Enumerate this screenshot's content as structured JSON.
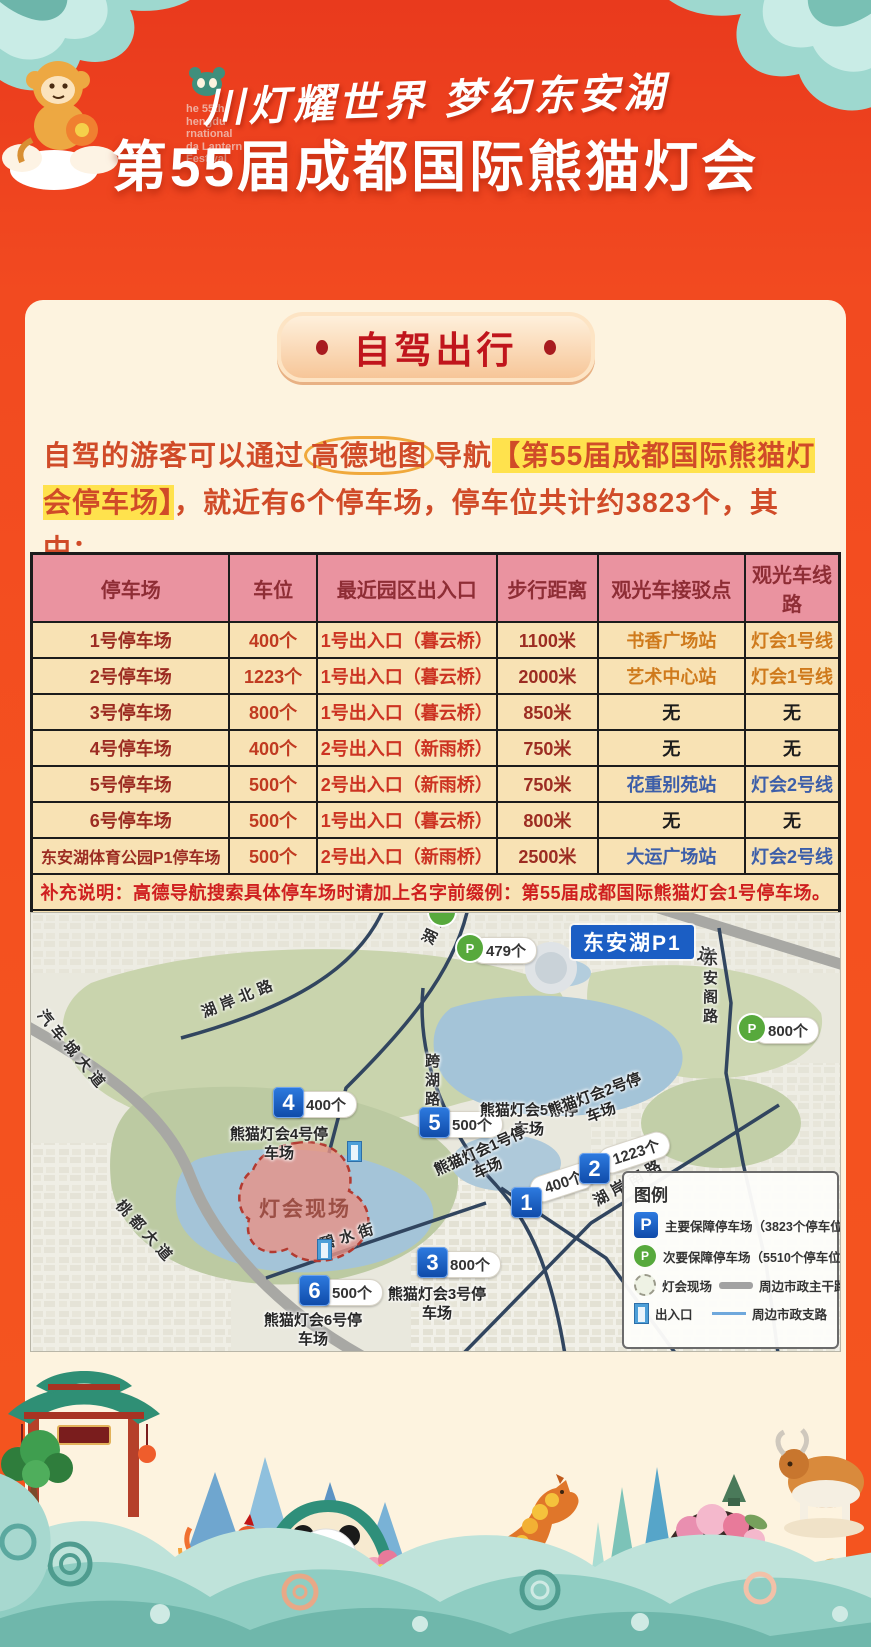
{
  "colors": {
    "accent_red": "#e8401f",
    "card_bg": "#fdf3df",
    "table_header_bg": "#ea93a0",
    "highlight_yellow": "#ffe24d",
    "marker_blue": "#1b5ec4",
    "marker_green": "#57a93c"
  },
  "header": {
    "festival_logo_text": "he 55th\nhengdu\nrnational\nda Lantern\nFestival",
    "subtitle": "川灯耀世界 梦幻东安湖",
    "title": "第55届成都国际熊猫灯会"
  },
  "section": {
    "badge": "自驾出行",
    "intro_pre": "自驾的游客可以通过",
    "intro_circled": "高德地图",
    "intro_mid": "导航",
    "intro_highlight": "【第55届成都国际熊猫灯会停车场】",
    "intro_post": "，就近有6个停车场，停车位共计约3823个，其中："
  },
  "table": {
    "headers": [
      "停车场",
      "车位",
      "最近园区出入口",
      "步行距离",
      "观光车接驳点",
      "观光车线路"
    ],
    "rows": [
      {
        "name": "1号停车场",
        "spots": "400个",
        "exit": "1号出入口（暮云桥）",
        "dist": "1100米",
        "station": "书香广场站",
        "line": "灯会1号线",
        "cls": "c-orange"
      },
      {
        "name": "2号停车场",
        "spots": "1223个",
        "exit": "1号出入口（暮云桥）",
        "dist": "2000米",
        "station": "艺术中心站",
        "line": "灯会1号线",
        "cls": "c-orange"
      },
      {
        "name": "3号停车场",
        "spots": "800个",
        "exit": "1号出入口（暮云桥）",
        "dist": "850米",
        "station": "无",
        "line": "无",
        "cls": "c-dark"
      },
      {
        "name": "4号停车场",
        "spots": "400个",
        "exit": "2号出入口（新雨桥）",
        "dist": "750米",
        "station": "无",
        "line": "无",
        "cls": "c-dark"
      },
      {
        "name": "5号停车场",
        "spots": "500个",
        "exit": "2号出入口（新雨桥）",
        "dist": "750米",
        "station": "花重别苑站",
        "line": "灯会2号线",
        "cls": "c-blue"
      },
      {
        "name": "6号停车场",
        "spots": "500个",
        "exit": "1号出入口（暮云桥）",
        "dist": "800米",
        "station": "无",
        "line": "无",
        "cls": "c-dark"
      },
      {
        "name": "东安湖体育公园P1停车场",
        "spots": "500个",
        "exit": "2号出入口（新雨桥）",
        "dist": "2500米",
        "station": "大运广场站",
        "line": "灯会2号线",
        "cls": "c-blue"
      }
    ],
    "note1": "补充说明：高德导航搜索具体停车场时请加上名字前缀例：第55届成都国际熊猫灯会1号停车场。",
    "note2": "温馨提示：所有的停车场、观光车接驳点、园区出入口都能使用高德地图导航和搜索，祝您游览愉快!"
  },
  "map": {
    "area_label": "东安湖P1",
    "site_label": "灯会现场",
    "p_glyph": "P",
    "markers": [
      {
        "n": "1",
        "count": "400个",
        "label": "熊猫灯会1号停车场"
      },
      {
        "n": "2",
        "count": "1223个",
        "label": "熊猫灯会2号停车场"
      },
      {
        "n": "3",
        "count": "800个",
        "label": "熊猫灯会3号停车场"
      },
      {
        "n": "4",
        "count": "400个",
        "label": "熊猫灯会4号停车场"
      },
      {
        "n": "5",
        "count": "500个",
        "label": "熊猫灯会5号停车场"
      },
      {
        "n": "6",
        "count": "500个",
        "label": "熊猫灯会6号停车场"
      }
    ],
    "green_markers": [
      {
        "count": "479个"
      },
      {
        "count": "800个"
      }
    ],
    "roads": [
      {
        "name": "汽车城大道"
      },
      {
        "name": "桃都大道"
      },
      {
        "name": "大道"
      },
      {
        "name": "湖岸北路"
      },
      {
        "name": "湖岸北路"
      },
      {
        "name": "跨湖路"
      },
      {
        "name": "湖岸南路"
      },
      {
        "name": "碧水街"
      },
      {
        "name": "东安阁路"
      }
    ],
    "legend": {
      "title": "图例",
      "primary": "主要保障停车场（3823个停车位）",
      "secondary": "次要保障停车场（5510个停车位）",
      "site": "灯会现场",
      "main_road": "周边市政主干路",
      "entrance": "出入口",
      "side_road": "周边市政支路"
    }
  }
}
